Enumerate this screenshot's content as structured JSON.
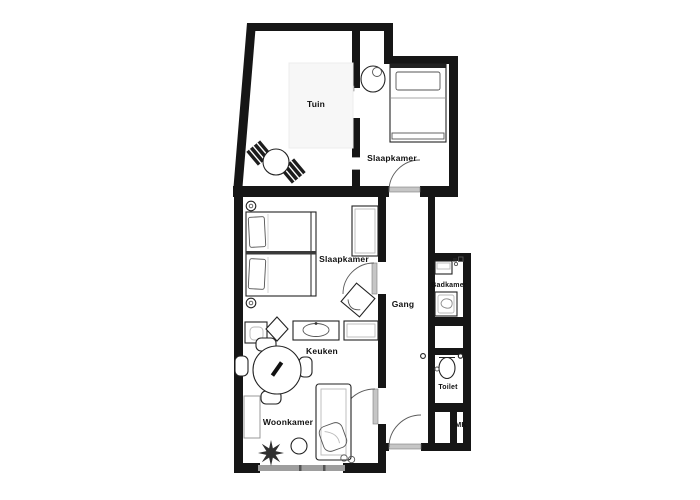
{
  "floorplan": {
    "background_color": "#ffffff",
    "wall_color": "#161616",
    "furniture_stroke_color": "#222222",
    "door_leaf_color": "#c6c6c6",
    "window_color": "#9e9e9e",
    "rooms": {
      "tuin": {
        "label": "Tuin"
      },
      "slaapkamer_top": {
        "label": "Slaapkamer"
      },
      "slaapkamer_mid": {
        "label": "Slaapkamer"
      },
      "gang": {
        "label": "Gang"
      },
      "badkamer": {
        "label": "Badkamer"
      },
      "keuken": {
        "label": "Keuken"
      },
      "toilet": {
        "label": "Toilet"
      },
      "woonkamer": {
        "label": "Woonkamer"
      },
      "mk": {
        "label": "MK"
      }
    }
  }
}
